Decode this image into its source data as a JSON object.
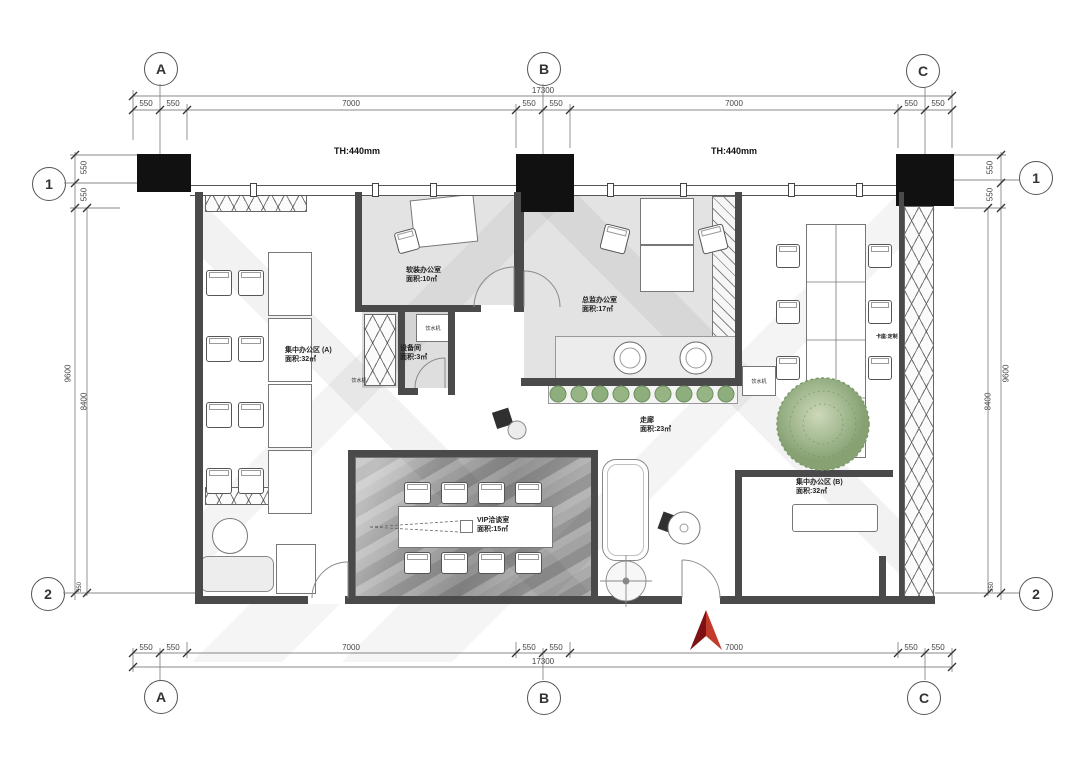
{
  "grid": {
    "cols": [
      "A",
      "B",
      "C"
    ],
    "rows": [
      "1",
      "2"
    ]
  },
  "dimensions": {
    "top": {
      "total": "17300",
      "segments": [
        "550",
        "550",
        "7000",
        "550",
        "550",
        "7000",
        "550",
        "550"
      ]
    },
    "bottom": {
      "total": "17300",
      "segments": [
        "550",
        "550",
        "7000",
        "550",
        "550",
        "7000",
        "550",
        "550"
      ]
    },
    "left": {
      "segments_top": [
        "550",
        "550"
      ],
      "total": "9600",
      "inner": "8400",
      "segment_bottom": "550"
    },
    "right": {
      "segments_top": [
        "550",
        "550"
      ],
      "total": "9600",
      "inner": "8400",
      "segment_bottom": "550"
    }
  },
  "annotations": {
    "ceiling_height_1": "TH:440mm",
    "ceiling_height_2": "TH:440mm"
  },
  "rooms": [
    {
      "id": "office-a",
      "name": "集中办公区 (A)",
      "area": "面积:32㎡"
    },
    {
      "id": "soft-deco-office",
      "name": "软装办公室",
      "area": "面积:10㎡"
    },
    {
      "id": "director-office",
      "name": "总监办公室",
      "area": "面积:17㎡"
    },
    {
      "id": "equipment-room",
      "name": "设备间",
      "area": "面积:3㎡"
    },
    {
      "id": "vip-room",
      "name": "VIP洽谈室",
      "area": "面积:15㎡"
    },
    {
      "id": "corridor",
      "name": "走廊",
      "area": "面积:23㎡"
    },
    {
      "id": "office-b",
      "name": "集中办公区 (B)",
      "area": "面积:32㎡"
    }
  ],
  "labels": {
    "water_dispenser": "饮水机",
    "custom_note": "卡座:定制"
  }
}
